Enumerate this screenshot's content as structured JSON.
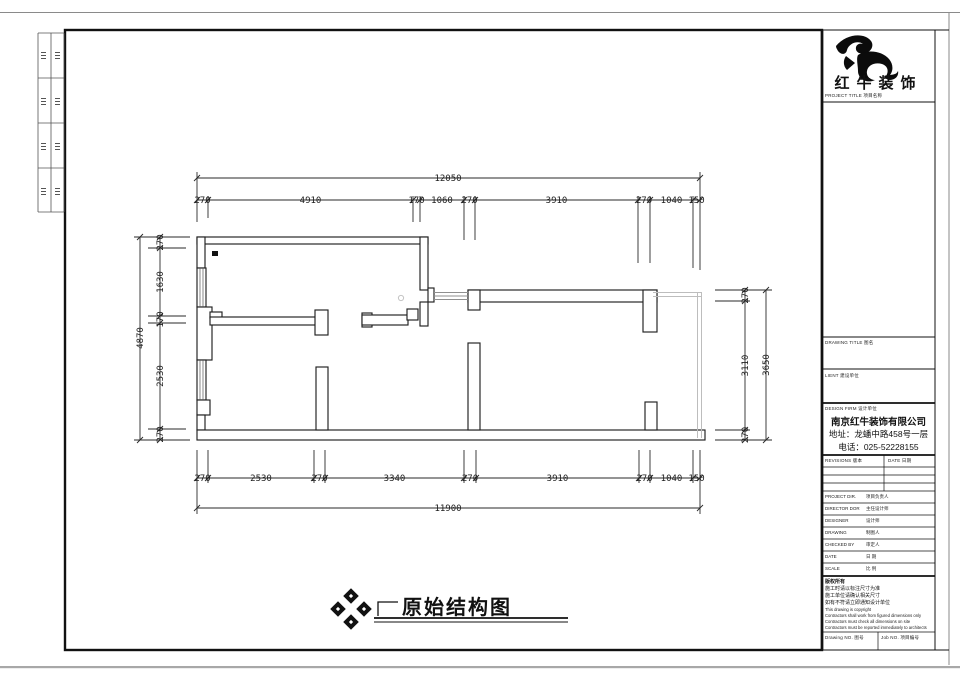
{
  "logo": {
    "name": "红牛装饰",
    "project_title_label": "PROJECT TITLE 项目名称"
  },
  "title_block": {
    "drawing_title_label": "DRAWING TITLE 图名",
    "client_label": "LIENT 建设单位",
    "design_firm_label": "DESIGN FIRM 设计单位",
    "company": {
      "name": "南京红牛装饰有限公司",
      "address": "地址：龙蟠中路458号一层",
      "phone": "电话：025-52228155"
    },
    "revisions_label": "REVISIONS 版本",
    "date_header_label": "DATE 日期",
    "staff": [
      {
        "en": "PROJECT DIR.",
        "zh": "项目负责人"
      },
      {
        "en": "DIRECTOR DOR",
        "zh": "主任设计师"
      },
      {
        "en": "DESIGNER",
        "zh": "设计师"
      },
      {
        "en": "DRAWING",
        "zh": "制图人"
      },
      {
        "en": "CHECKED BY",
        "zh": "审定人"
      },
      {
        "en": "DATE",
        "zh": "日 期"
      },
      {
        "en": "SCALE",
        "zh": "比 例"
      }
    ],
    "copyright": [
      "版权所有",
      "施工时请以标注尺寸为准",
      "施工单位请确认相关尺寸",
      "如有不符请立即通知设计单位",
      "This drawing is copyright",
      "Contractors shall work from figured dimensions only",
      "Contractors must check all dimensions on site",
      "Contractors must be reported immediately to architects"
    ],
    "footer": {
      "drawing_no_label": "Drawing NO. 图号",
      "job_no_label": "Job NO. 项目编号"
    }
  },
  "drawing": {
    "title": "原始结构图",
    "dims": {
      "top": {
        "overall": "12050",
        "segments": [
          "270",
          "4910",
          "170",
          "1060",
          "270",
          "3910",
          "270",
          "1040",
          "150"
        ]
      },
      "bottom": {
        "overall": "11900",
        "segments": [
          "270",
          "2530",
          "270",
          "3340",
          "270",
          "3910",
          "270",
          "1040",
          "150"
        ]
      },
      "left": {
        "overall": "4870",
        "segments": [
          "270",
          "1630",
          "170",
          "2530",
          "270"
        ]
      },
      "right": {
        "overall": "3650",
        "segments": [
          "270",
          "3110",
          "270"
        ]
      }
    }
  }
}
